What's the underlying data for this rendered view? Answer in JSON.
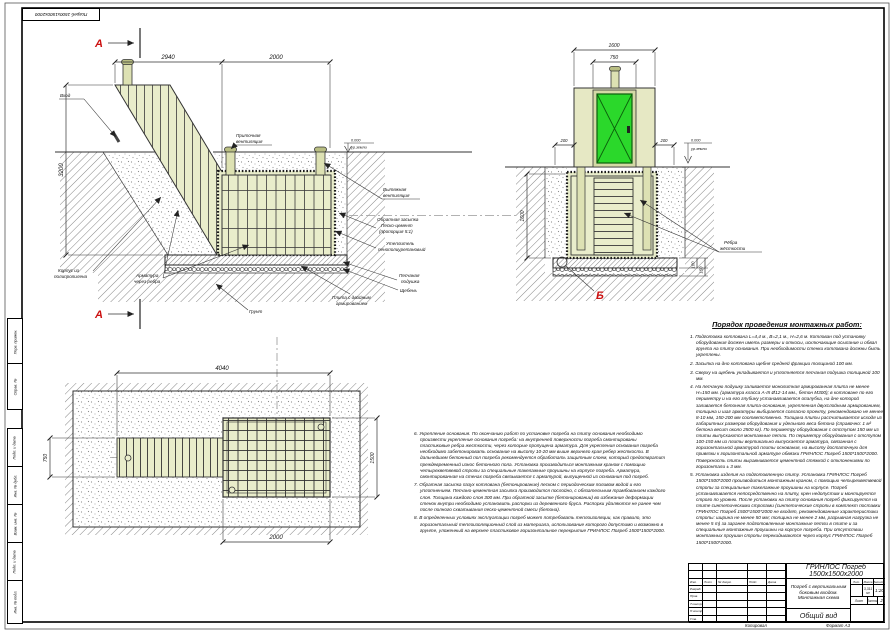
{
  "colors": {
    "body_fill": "#e9edcb",
    "door_green": "#2bd82b",
    "marker_red": "#cc1111"
  },
  "sheet": {
    "top_left_stamp": "Погреб 1500х1500х2000",
    "side_stamps": [
      "Перв. примен.",
      "Справ. №",
      "Подп. и дата",
      "Инв. № дубл.",
      "Взам. инв. №",
      "Подп. и дата",
      "Инв. № подл."
    ],
    "copied_label": "Копировал",
    "format_label": "Формат А3"
  },
  "section_a": {
    "marker": "А",
    "dims": {
      "top_left": "2940",
      "top_right": "2000",
      "left": "3200"
    },
    "elevation": {
      "value": "0.000",
      "ref": "ур.земли"
    },
    "labels": {
      "vhod": "Вход",
      "pritochnaya1": "Приточная",
      "pritochnaya2": "вентиляция",
      "vytyazhnaya1": "Вытяжная",
      "vytyazhnaya2": "вентиляция",
      "zasypka1": "Обратная засыпка",
      "zasypka2": "Песко-цемент",
      "zasypka3": "(пропорция 5:1)",
      "uteplitel1": "Утеплитель",
      "uteplitel2": "пенополиуретановый",
      "podushka1": "Песчаная",
      "podushka2": "подушка",
      "scheben": "Щебень",
      "plita1": "Плита с двойным",
      "plita2": "армированием",
      "korpus1": "Корпус из",
      "korpus2": "полипропилена",
      "armatura1": "Арматура",
      "armatura2": "через ребра",
      "grunt": "Грунт"
    }
  },
  "section_b": {
    "marker": "Б",
    "dims": {
      "top": "1600",
      "door": "750",
      "offset_left": "200",
      "offset_right": "200",
      "depth": "1600",
      "t1": "100",
      "t2": "150"
    },
    "elevation": {
      "value": "0.000",
      "ref": "ур.земли"
    },
    "labels": {
      "rebra1": "Рёбра",
      "rebra2": "жёсткости"
    }
  },
  "plan": {
    "dims": {
      "length": "4040",
      "entry_width": "750",
      "body_width": "1500",
      "body_length": "2000"
    }
  },
  "notes_right": {
    "title": "Порядок проведения монтажных работ:",
    "items": [
      "1. Подготовка котлована L=4,4 м., В=2,1 м., Н=2,6 м. Котлован под установку оборудования должен иметь размеры и откосы, исключающие осыпание и обвал грунта на плиту основания. При необходимости стенки котлована должны быть укреплены.",
      "2. Засыпка на дно котлована щебня средней фракции толщиной 100 мм.",
      "3. Сверху на щебень укладывается и уплотняется песчаная подушка толщиной 100 мм.",
      "4. На песчаную подушку заливается монолитная армированная плита не менее Н=150 мм. (арматура класса А-III Ø12-14 мм., бетон М300); в котловане по его периметру и на его глубину устанавливается опалубка, на дне которой заливается бетонная плита-основание, укрепленная двухслойным армированием, толщина и шаг арматуры выбирается согласно проекту, рекомендовано не менее 8-10 мм, 150-200 мм соответственно. Толщина плиты рассчитывается исходя из габаритных размеров оборудования и удельного веса бетона (справочно: 1 м³ бетона весит около 2500 кг). По периметру оборудования с отступом 150 мм из плиты выпускаются монтажные петли. По периметру оборудования с отступом 100-150 мм из плиты вертикально выпускается арматура, связанная с горизонтальной арматурой плиты основания, на высоту достаточную для привязки к горизонтальной арматуре обвязки ГРИНЛОС Погреб 1500*1500*2000. Поверхность плиты выравнивается цементной стяжкой с отклонениями по горизонтали ± 3 мм.",
      "5. Установка изделия на подготовленную плиту. Установка ГРИНЛОС Погреб 1500*1500*2000 производиться монтажным краном, с помощью четырехветвевой стропы за специальные такелажные проушины на корпусе. Погреб устанавливается непосредственно на плиту, крен недопустим и монтируется строго по уровню. После установки на плиту основания погреб фиксируется на плите синтетическими стропами (синтетические стропы в комплект поставки ГРИНЛОС Погреб 1500*1500*2000 не входят, рекомендованные характеристики стропы: ширина не менее 50 мм; толщина не менее 2 мм, разрывная нагрузка не менее 5 т) за заранее подготовленные монтажные петли в плите и за специальные монтажные проушины на корпусе погреба. При отсутствии монтажных проушин стропы перекидываются через корпус ГРИНЛОС Погреб 1500*1500*2000."
    ]
  },
  "notes_mid": {
    "items": [
      "6. Укрепление основания. По окончанию работ по установке погреба на плиту основания необходимо произвести укрепление основания погреба: на внутренней поверхности погреба смонтированы пластиковые ребра жесткости, через которые пропущена арматура. Для укрепления основания погреба необходимо забетонировать основание на высоту 10-20 мм выше верхнего края ребер жесткости. В дальнейшем бетонный пол погреба рекомендуется обработать защитным слоем, который предотвратит преждевременный износ бетонного пола. Установка производиться монтажным краном с помощью четырехветвевой стропы за специальные такелажные проушины на корпусе погреба. Арматура, смонтированная на стенах погреба связывается с арматурой, выпущенной из основания под погреб.",
      "7. Обратная засыпка пазух котлована (бетонирование) песком с периодическим поливом водой и его уплотнением. Песчано-цементная засыпка производится послойно, с обязательным трамбованием каждого слоя. Толщина каждого слоя 300 мм. При обратной засыпке (бетонировании) во избежание деформации стенок внутри необходимо установить распорки из деревянного бруса. Распорки удаляются не ранее чем после полного схватывания песко-цементной смеси (бетона).",
      "8. В определенных условиях эксплуатации погреб может потребовать теплоизоляции, как правило, это горизонтальный теплоизоляционный слой из материала, использование которого допустимо и возможно в грунте, уложенный на верхнее пластиковое горизонтальное перекрытие ГРИНЛОС Погреб 1500*1500*2000."
    ]
  },
  "titleblock": {
    "product": "ГРИНЛОС Погреб 1500х1500х2000",
    "desc1": "Погреб с вертикальным",
    "desc2": "боковым входом.",
    "desc3": "Монтажная схема",
    "view": "Общий вид",
    "col_izm": "Изм.",
    "col_list": "Лист",
    "col_ndok": "№ докум.",
    "col_podp": "Подп.",
    "col_data": "Дата",
    "row_razrab": "Разраб.",
    "row_prov": "Пров.",
    "row_tkontr": "Т.контр.",
    "row_nkontr": "Н.контр.",
    "row_utv": "Утв.",
    "lit_h": "Лит.",
    "mass_h": "Масса",
    "scale_h": "Масштаб",
    "mass": "3,311 м³",
    "scale": "1:20",
    "list_h": "Лист",
    "listov_h": "Листов",
    "listov_val": "2"
  }
}
